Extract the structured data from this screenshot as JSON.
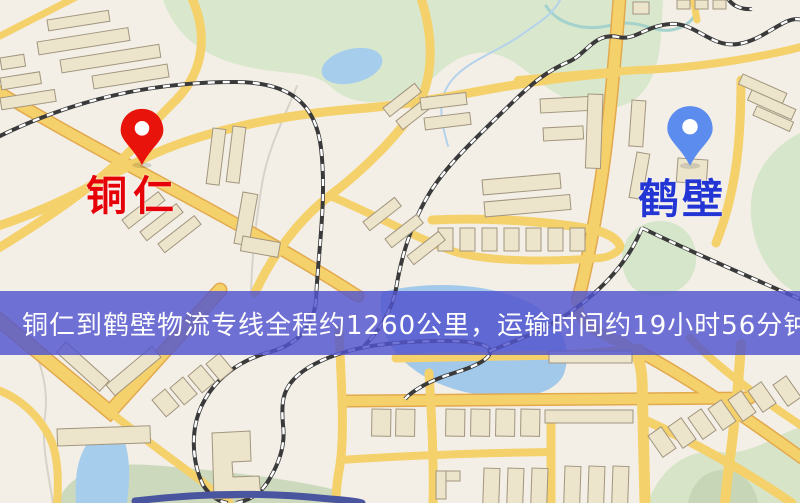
{
  "banner": {
    "text": "铜仁到鹤壁物流专线全程约1260公里，运输时间约19小时56分钟.",
    "distance_km": 1260,
    "duration_hours": 19,
    "duration_minutes": 56,
    "background_color": "#5254cd",
    "text_color": "#ffffff"
  },
  "markers": {
    "origin": {
      "label": "铜仁",
      "pin_color": "#e8130a",
      "label_color": "#e60008",
      "pin_style": "red-map-pin"
    },
    "destination": {
      "label": "鹤壁",
      "pin_color": "#5b8cee",
      "label_color": "#2336d4",
      "pin_style": "blue-map-pin"
    }
  },
  "map_palette": {
    "background": "#f3efe7",
    "road": "#f5d16b",
    "road_casing": "#e2a94e",
    "park": "#d9e8cd",
    "water": "#a6cdec",
    "railway": "#333333",
    "building": "#ece4cb"
  }
}
